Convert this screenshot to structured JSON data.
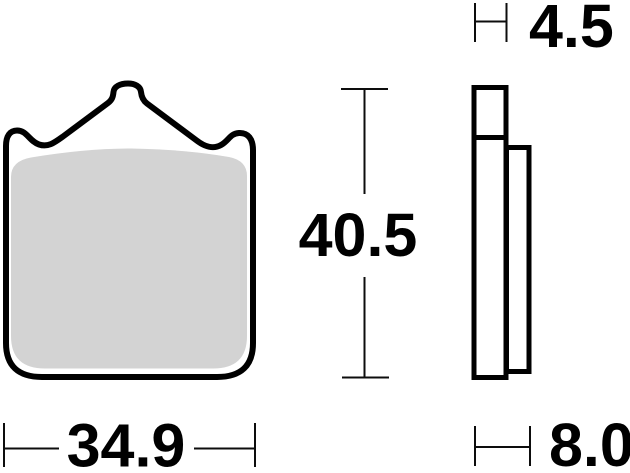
{
  "diagram": {
    "front_view": {
      "width": "34.9",
      "height": "40.5"
    },
    "side_view": {
      "backplate_thickness": "4.5",
      "total_thickness": "8.0"
    },
    "colors": {
      "line": "#000000",
      "friction_material": "#d3d3d3",
      "background": "#ffffff"
    }
  }
}
